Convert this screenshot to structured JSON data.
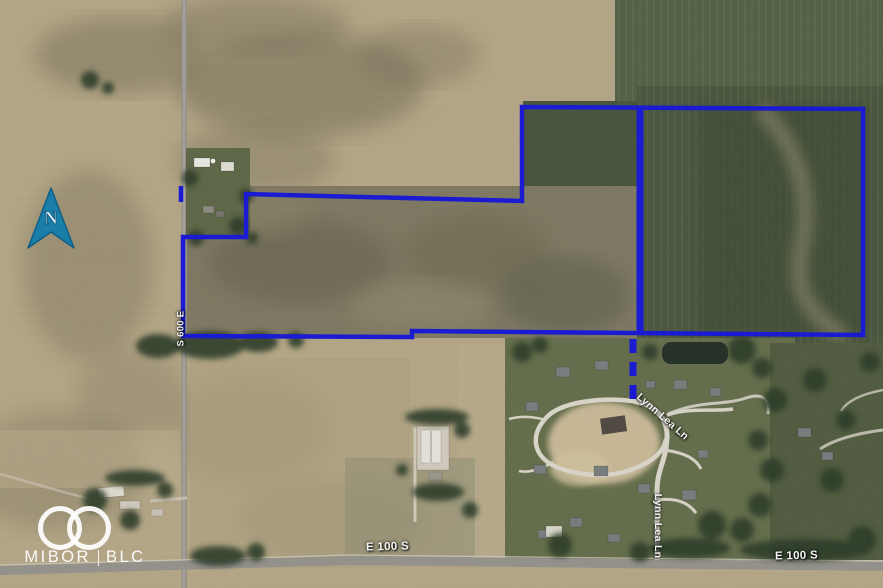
{
  "map": {
    "compass": {
      "label": "N",
      "color": "#1a7ea9"
    },
    "road_labels": {
      "s600e": "S 600 E",
      "lynn_lea_upper": "Lynn Lea Ln",
      "lynn_lea_lower": "Lynn Lea Ln",
      "e100s_west": "E 100 S",
      "e100s_east": "E 100 S"
    },
    "watermark": {
      "brand": "MIBOR",
      "suffix": "BLC"
    },
    "parcel_boundary": {
      "color": "#1b1bd2",
      "style_main": "solid",
      "style_connector": "dashed"
    }
  }
}
